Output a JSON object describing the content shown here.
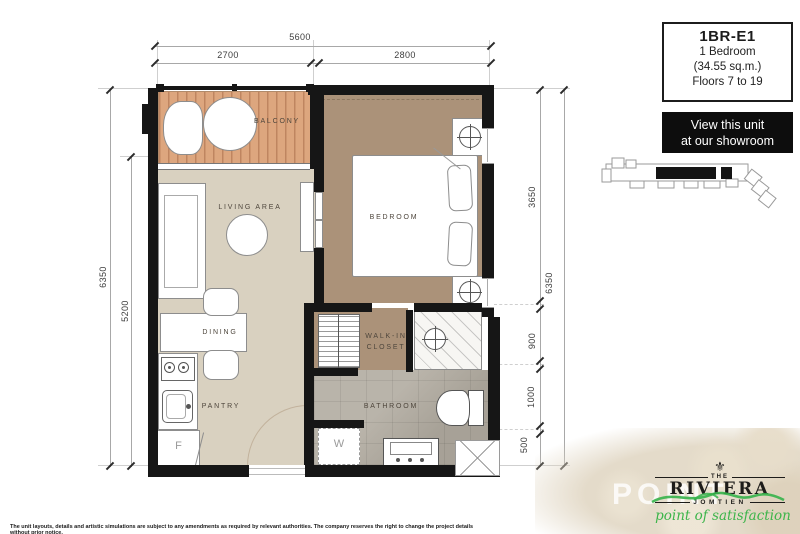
{
  "header": {
    "info_box": {
      "code": "1BR-E1",
      "type": "1 Bedroom",
      "area": "(34.55 sq.m.)",
      "floors": "Floors 7 to 19"
    },
    "showroom": {
      "line1": "View this unit",
      "line2": "at our showroom"
    }
  },
  "plan": {
    "labels": {
      "balcony": "BALCONY",
      "living": "LIVING AREA",
      "bedroom": "BEDROOM",
      "dining": "DINING",
      "pantry": "PANTRY",
      "walkin_line1": "WALK-IN",
      "walkin_line2": "CLOSET",
      "bathroom": "BATHROOM",
      "fridge": "F",
      "washer": "W"
    },
    "dimensions": {
      "top_total": "5600",
      "top_left": "2700",
      "top_right": "2800",
      "left_outer": "6350",
      "left_inner": "5200",
      "right_seg1": "3650",
      "right_seg2": "900",
      "right_seg3": "1000",
      "right_seg4": "500",
      "right_outer": "6350"
    }
  },
  "footer": {
    "disclaimer": "The unit layouts, details and artistic simulations are subject to any amendments as required by relevant authorities.  The company reserves the right to change the project details without prior notice.",
    "logo": {
      "the": "THE",
      "name": "RIVIERA",
      "location": "JOMTIEN",
      "tagline": "point of satisfaction"
    },
    "watermark": "POINT"
  },
  "colors": {
    "wall": "#161616",
    "floor_beige": "#d9d1c0",
    "floor_tan": "#ab9279",
    "deck_wood": "#dda67e",
    "tile_gray": "#b1aba0",
    "accent_green": "#3db54b"
  }
}
